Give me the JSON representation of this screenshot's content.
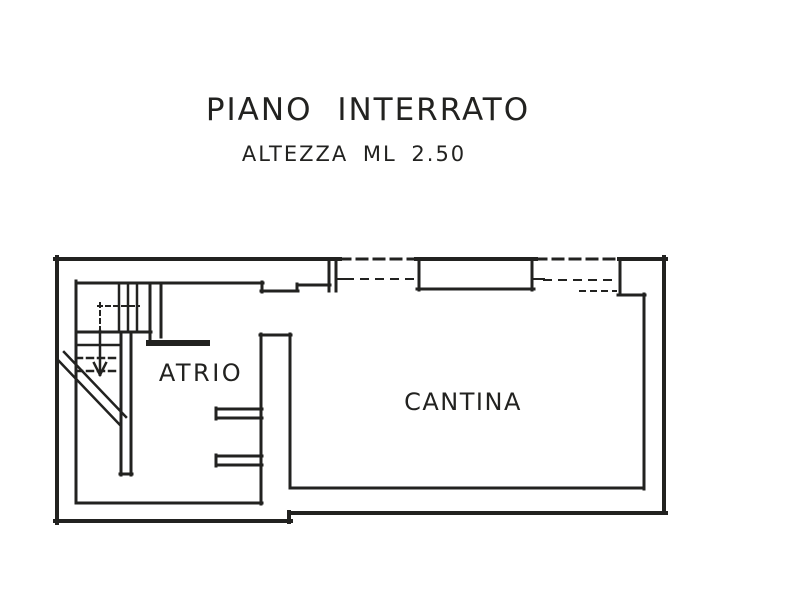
{
  "page": {
    "background": "#ffffff",
    "ink": "#222220"
  },
  "header": {
    "title": "PIANO INTERRATO",
    "subtitle": "ALTEZZA ML 2.50"
  },
  "rooms": [
    {
      "name": "ATRIO",
      "x": 201,
      "y": 381,
      "font_size": 24,
      "letter_spacing": 2.5
    },
    {
      "name": "CANTINA",
      "x": 463,
      "y": 410,
      "font_size": 24,
      "letter_spacing": 1.5
    }
  ],
  "plan": {
    "stroke": "#222220",
    "segments": [
      {
        "name": "outer-wall-left",
        "x1": 57,
        "y1": 257,
        "x2": 57,
        "y2": 523,
        "w": 4
      },
      {
        "name": "outer-wall-bottom-left",
        "x1": 55,
        "y1": 521,
        "x2": 291,
        "y2": 521,
        "w": 4
      },
      {
        "name": "outer-wall-bottom-step",
        "x1": 289,
        "y1": 522,
        "x2": 289,
        "y2": 512,
        "w": 4
      },
      {
        "name": "outer-wall-bottom-right",
        "x1": 289,
        "y1": 513,
        "x2": 666,
        "y2": 513,
        "w": 4
      },
      {
        "name": "outer-wall-right",
        "x1": 664,
        "y1": 513,
        "x2": 664,
        "y2": 257,
        "w": 4
      },
      {
        "name": "outer-wall-top-1",
        "x1": 55,
        "y1": 259,
        "x2": 340,
        "y2": 259,
        "w": 4
      },
      {
        "name": "outer-wall-top-2",
        "x1": 340,
        "y1": 259,
        "x2": 416,
        "y2": 259,
        "w": 3,
        "dash": "10 7"
      },
      {
        "name": "outer-wall-top-3",
        "x1": 416,
        "y1": 259,
        "x2": 536,
        "y2": 259,
        "w": 4
      },
      {
        "name": "outer-wall-top-4",
        "x1": 536,
        "y1": 259,
        "x2": 619,
        "y2": 259,
        "w": 3,
        "dash": "10 7"
      },
      {
        "name": "outer-wall-top-5",
        "x1": 619,
        "y1": 259,
        "x2": 666,
        "y2": 259,
        "w": 4
      },
      {
        "name": "inner-wall-left",
        "x1": 76,
        "y1": 281,
        "x2": 76,
        "y2": 503,
        "w": 3
      },
      {
        "name": "inner-wall-top",
        "x1": 76,
        "y1": 283,
        "x2": 263,
        "y2": 283,
        "w": 3
      },
      {
        "name": "door-recess-left",
        "x1": 262,
        "y1": 282,
        "x2": 262,
        "y2": 292,
        "w": 3
      },
      {
        "name": "door-recess-bottom",
        "x1": 261,
        "y1": 291,
        "x2": 298,
        "y2": 291,
        "w": 3
      },
      {
        "name": "door-recess-right",
        "x1": 297,
        "y1": 291,
        "x2": 297,
        "y2": 284,
        "w": 3
      },
      {
        "name": "inner-wall-top-2",
        "x1": 297,
        "y1": 285,
        "x2": 330,
        "y2": 285,
        "w": 3
      },
      {
        "name": "window-jamb-1a",
        "x1": 329,
        "y1": 259,
        "x2": 329,
        "y2": 291,
        "w": 3
      },
      {
        "name": "window-jamb-1b",
        "x1": 336,
        "y1": 259,
        "x2": 336,
        "y2": 291,
        "w": 3
      },
      {
        "name": "window-tick-1",
        "x1": 336,
        "y1": 279,
        "x2": 346,
        "y2": 279,
        "w": 2
      },
      {
        "name": "window-sill-dashed-1",
        "x1": 346,
        "y1": 279,
        "x2": 414,
        "y2": 279,
        "w": 2,
        "dash": "7 8"
      },
      {
        "name": "window-pier-left",
        "x1": 419,
        "y1": 260,
        "x2": 419,
        "y2": 290,
        "w": 3
      },
      {
        "name": "window-pier-right",
        "x1": 532,
        "y1": 260,
        "x2": 532,
        "y2": 290,
        "w": 3
      },
      {
        "name": "window-pier-bottom",
        "x1": 417,
        "y1": 289,
        "x2": 534,
        "y2": 289,
        "w": 3
      },
      {
        "name": "window-tick-2",
        "x1": 534,
        "y1": 279,
        "x2": 544,
        "y2": 279,
        "w": 2
      },
      {
        "name": "window-sill-dashed-2",
        "x1": 544,
        "y1": 280,
        "x2": 612,
        "y2": 280,
        "w": 2,
        "dash": "7 8"
      },
      {
        "name": "window-sill-dashed-3",
        "x1": 580,
        "y1": 291,
        "x2": 616,
        "y2": 291,
        "w": 2,
        "dash": "5 6"
      },
      {
        "name": "corner-step-vertical",
        "x1": 620,
        "y1": 259,
        "x2": 620,
        "y2": 295,
        "w": 3
      },
      {
        "name": "corner-step-horizontal",
        "x1": 618,
        "y1": 295,
        "x2": 645,
        "y2": 295,
        "w": 3
      },
      {
        "name": "inner-wall-right",
        "x1": 644,
        "y1": 294,
        "x2": 644,
        "y2": 489,
        "w": 3
      },
      {
        "name": "inner-wall-bottom-right",
        "x1": 644,
        "y1": 488,
        "x2": 291,
        "y2": 488,
        "w": 3
      },
      {
        "name": "partition-wall-left",
        "x1": 261,
        "y1": 334,
        "x2": 261,
        "y2": 504,
        "w": 3
      },
      {
        "name": "partition-wall-right",
        "x1": 290,
        "y1": 334,
        "x2": 290,
        "y2": 488,
        "w": 3
      },
      {
        "name": "partition-wall-cap",
        "x1": 260,
        "y1": 335,
        "x2": 291,
        "y2": 335,
        "w": 3
      },
      {
        "name": "inner-wall-bottom-left",
        "x1": 76,
        "y1": 503,
        "x2": 262,
        "y2": 503,
        "w": 3
      },
      {
        "name": "niche-upper-top",
        "x1": 216,
        "y1": 409,
        "x2": 262,
        "y2": 409,
        "w": 3
      },
      {
        "name": "niche-upper-bottom",
        "x1": 216,
        "y1": 418,
        "x2": 262,
        "y2": 418,
        "w": 3
      },
      {
        "name": "niche-upper-cap",
        "x1": 216,
        "y1": 408,
        "x2": 216,
        "y2": 419,
        "w": 3
      },
      {
        "name": "niche-lower-top",
        "x1": 216,
        "y1": 456,
        "x2": 262,
        "y2": 456,
        "w": 3
      },
      {
        "name": "niche-lower-bottom",
        "x1": 216,
        "y1": 465,
        "x2": 262,
        "y2": 465,
        "w": 3
      },
      {
        "name": "niche-lower-cap",
        "x1": 216,
        "y1": 455,
        "x2": 216,
        "y2": 466,
        "w": 3
      },
      {
        "name": "stair-landing-edge",
        "x1": 76,
        "y1": 332,
        "x2": 151,
        "y2": 332,
        "w": 3
      },
      {
        "name": "stair-wall-right-a",
        "x1": 150,
        "y1": 284,
        "x2": 150,
        "y2": 343,
        "w": 3
      },
      {
        "name": "stair-wall-right-b",
        "x1": 161,
        "y1": 284,
        "x2": 161,
        "y2": 337,
        "w": 3
      },
      {
        "name": "stair-step-wall",
        "x1": 149,
        "y1": 343,
        "x2": 207,
        "y2": 343,
        "w": 6
      },
      {
        "name": "stair-riser-1",
        "x1": 119,
        "y1": 285,
        "x2": 119,
        "y2": 331,
        "w": 2.5
      },
      {
        "name": "stair-riser-2",
        "x1": 128,
        "y1": 285,
        "x2": 128,
        "y2": 331,
        "w": 2.5
      },
      {
        "name": "stair-riser-3",
        "x1": 137,
        "y1": 285,
        "x2": 137,
        "y2": 331,
        "w": 2.5
      },
      {
        "name": "stair-tread-1",
        "x1": 76,
        "y1": 345,
        "x2": 120,
        "y2": 345,
        "w": 2.5
      },
      {
        "name": "stair-tread-2",
        "x1": 76,
        "y1": 358,
        "x2": 120,
        "y2": 358,
        "w": 2.5,
        "dash": "6 5"
      },
      {
        "name": "stair-tread-3",
        "x1": 76,
        "y1": 371,
        "x2": 120,
        "y2": 371,
        "w": 2.5,
        "dash": "6 5"
      },
      {
        "name": "stair-wall-center-a",
        "x1": 121,
        "y1": 333,
        "x2": 121,
        "y2": 475,
        "w": 3
      },
      {
        "name": "stair-wall-center-b",
        "x1": 131,
        "y1": 333,
        "x2": 131,
        "y2": 475,
        "w": 3
      },
      {
        "name": "stair-wall-center-cap",
        "x1": 120,
        "y1": 474,
        "x2": 132,
        "y2": 474,
        "w": 3
      },
      {
        "name": "stair-dashed-line-v",
        "x1": 100,
        "y1": 303,
        "x2": 100,
        "y2": 330,
        "w": 2,
        "dash": "4 4"
      },
      {
        "name": "stair-dashed-line-h",
        "x1": 98,
        "y1": 306,
        "x2": 139,
        "y2": 306,
        "w": 2,
        "dash": "4 4"
      },
      {
        "name": "stair-break-line-1",
        "x1": 64,
        "y1": 352,
        "x2": 126,
        "y2": 417,
        "w": 2.5
      },
      {
        "name": "stair-break-line-2",
        "x1": 58,
        "y1": 360,
        "x2": 120,
        "y2": 425,
        "w": 2.5
      },
      {
        "name": "stair-arrow-shaft",
        "x1": 100,
        "y1": 331,
        "x2": 100,
        "y2": 372,
        "w": 2.5
      },
      {
        "name": "stair-arrow-barb-left",
        "x1": 94,
        "y1": 363,
        "x2": 100,
        "y2": 375,
        "w": 2.5
      },
      {
        "name": "stair-arrow-barb-right",
        "x1": 106,
        "y1": 363,
        "x2": 100,
        "y2": 375,
        "w": 2.5
      }
    ]
  }
}
